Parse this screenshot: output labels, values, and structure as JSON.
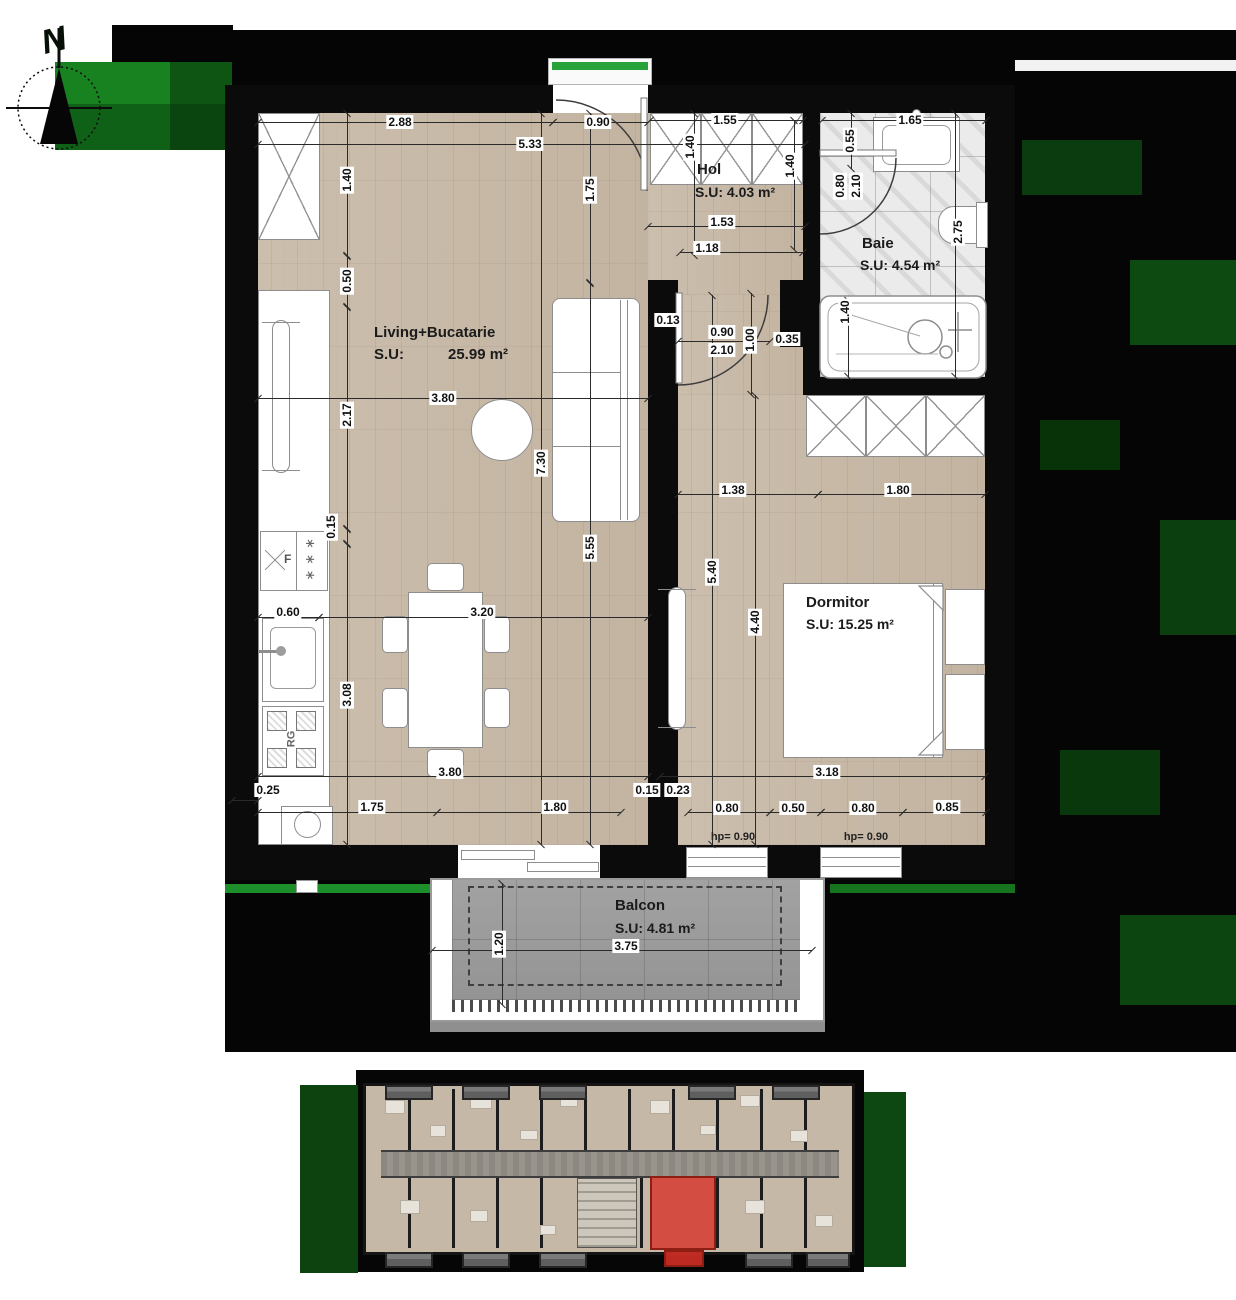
{
  "compass": {
    "north_label": "N"
  },
  "rooms": {
    "living": {
      "name": "Living+Bucatarie",
      "su_label": "S.U:",
      "area": "25.99 m²"
    },
    "hol": {
      "name": "Hol",
      "area": "S.U: 4.03 m²"
    },
    "baie": {
      "name": "Baie",
      "area": "S.U: 4.54 m²"
    },
    "dormitor": {
      "name": "Dormitor",
      "area": "S.U: 15.25 m²"
    },
    "balcon": {
      "name": "Balcon",
      "area": "S.U: 4.81 m²"
    }
  },
  "annotations": {
    "stove": "RG",
    "fridge": "F",
    "freezer": "∗∗∗"
  },
  "colors": {
    "wall": "#0b0b0b",
    "wood_floor": "#c9bbaa",
    "marble_floor": "#ebebeb",
    "balcony_tile": "#9d9d9d",
    "artifact_green": "#116b1c",
    "highlight_red": "#d63026"
  },
  "dimensions": [
    {
      "v": "2.88",
      "x": 400,
      "y": 122,
      "o": "h",
      "line": [
        258,
        122,
        553,
        122
      ]
    },
    {
      "v": "0.90",
      "x": 598,
      "y": 122,
      "o": "h",
      "line": [
        553,
        122,
        648,
        122
      ]
    },
    {
      "v": "5.33",
      "x": 530,
      "y": 144,
      "o": "h",
      "line": [
        258,
        144,
        805,
        144
      ]
    },
    {
      "v": "1.55",
      "x": 725,
      "y": 120,
      "o": "h",
      "line": [
        650,
        120,
        803,
        120
      ]
    },
    {
      "v": "0.55",
      "x": 850,
      "y": 141,
      "o": "v",
      "line": [
        851,
        113,
        851,
        169
      ]
    },
    {
      "v": "1.65",
      "x": 910,
      "y": 120,
      "o": "h",
      "line": [
        822,
        120,
        986,
        120
      ]
    },
    {
      "v": "1.40",
      "x": 690,
      "y": 147,
      "o": "v",
      "line": [
        694,
        113,
        694,
        256
      ]
    },
    {
      "v": "1.40",
      "x": 790,
      "y": 166,
      "o": "v",
      "line": [
        794,
        120,
        794,
        250
      ]
    },
    {
      "v": "1.75",
      "x": 590,
      "y": 190,
      "o": "v",
      "line": [
        590,
        113,
        590,
        283
      ]
    },
    {
      "v": "5.55",
      "x": 590,
      "y": 548,
      "o": "v",
      "line": [
        590,
        283,
        590,
        845
      ]
    },
    {
      "v": "7.30",
      "x": 541,
      "y": 463,
      "o": "v",
      "line": [
        541,
        113,
        541,
        845
      ]
    },
    {
      "v": "1.40",
      "x": 347,
      "y": 180,
      "o": "v",
      "line": [
        347,
        113,
        347,
        256
      ]
    },
    {
      "v": "0.50",
      "x": 347,
      "y": 281,
      "o": "v",
      "line": [
        347,
        256,
        347,
        307
      ]
    },
    {
      "v": "2.17",
      "x": 347,
      "y": 415,
      "o": "v",
      "line": [
        347,
        307,
        347,
        529
      ]
    },
    {
      "v": "0.15",
      "x": 331,
      "y": 527,
      "o": "v",
      "line": [
        347,
        529,
        347,
        544
      ]
    },
    {
      "v": "3.08",
      "x": 347,
      "y": 695,
      "o": "v",
      "line": [
        347,
        544,
        347,
        845
      ]
    },
    {
      "v": "0.60",
      "x": 288,
      "y": 612,
      "o": "h",
      "line": [
        258,
        617,
        319,
        617
      ]
    },
    {
      "v": "3.20",
      "x": 482,
      "y": 612,
      "o": "h",
      "line": [
        319,
        617,
        648,
        617
      ]
    },
    {
      "v": "3.80",
      "x": 443,
      "y": 398,
      "o": "h",
      "line": [
        258,
        398,
        648,
        398
      ]
    },
    {
      "v": "1.53",
      "x": 722,
      "y": 222,
      "o": "h",
      "line": [
        648,
        226,
        805,
        226
      ]
    },
    {
      "v": "1.18",
      "x": 707,
      "y": 248,
      "o": "h",
      "line": [
        680,
        252,
        803,
        252
      ]
    },
    {
      "v": "0.13",
      "x": 668,
      "y": 320,
      "o": "h"
    },
    {
      "v": "0.90",
      "x": 722,
      "y": 332,
      "o": "h",
      "line": [
        678,
        341,
        770,
        341
      ]
    },
    {
      "v": "2.10",
      "x": 722,
      "y": 350,
      "o": "h"
    },
    {
      "v": "1.00",
      "x": 750,
      "y": 340,
      "o": "v",
      "line": [
        751,
        293,
        751,
        395
      ]
    },
    {
      "v": "0.35",
      "x": 787,
      "y": 339,
      "o": "h"
    },
    {
      "v": "0.80",
      "x": 840,
      "y": 186,
      "o": "v"
    },
    {
      "v": "2.10",
      "x": 856,
      "y": 186,
      "o": "v"
    },
    {
      "v": "2.75",
      "x": 958,
      "y": 232,
      "o": "v",
      "line": [
        955,
        113,
        955,
        377
      ]
    },
    {
      "v": "1.40",
      "x": 845,
      "y": 312,
      "o": "v",
      "line": [
        848,
        300,
        848,
        377
      ]
    },
    {
      "v": "1.38",
      "x": 733,
      "y": 490,
      "o": "h",
      "line": [
        678,
        494,
        818,
        494
      ]
    },
    {
      "v": "1.80",
      "x": 898,
      "y": 490,
      "o": "h",
      "line": [
        818,
        494,
        985,
        494
      ]
    },
    {
      "v": "5.40",
      "x": 712,
      "y": 572,
      "o": "v",
      "line": [
        712,
        295,
        712,
        845
      ]
    },
    {
      "v": "4.40",
      "x": 755,
      "y": 622,
      "o": "v",
      "line": [
        755,
        395,
        755,
        845
      ]
    },
    {
      "v": "3.80",
      "x": 450,
      "y": 772,
      "o": "h",
      "line": [
        258,
        776,
        648,
        776
      ]
    },
    {
      "v": "3.18",
      "x": 827,
      "y": 772,
      "o": "h",
      "line": [
        660,
        776,
        985,
        776
      ]
    },
    {
      "v": "0.25",
      "x": 268,
      "y": 790,
      "o": "h",
      "line": [
        232,
        800,
        258,
        800
      ]
    },
    {
      "v": "1.75",
      "x": 372,
      "y": 807,
      "o": "h",
      "line": [
        258,
        812,
        437,
        812
      ]
    },
    {
      "v": "1.80",
      "x": 555,
      "y": 807,
      "o": "h",
      "line": [
        437,
        812,
        621,
        812
      ]
    },
    {
      "v": "0.15",
      "x": 647,
      "y": 790,
      "o": "h"
    },
    {
      "v": "0.23",
      "x": 678,
      "y": 790,
      "o": "h"
    },
    {
      "v": "0.80",
      "x": 727,
      "y": 808,
      "o": "h",
      "line": [
        688,
        812,
        770,
        812
      ]
    },
    {
      "v": "0.50",
      "x": 793,
      "y": 808,
      "o": "h",
      "line": [
        770,
        812,
        821,
        812
      ]
    },
    {
      "v": "0.80",
      "x": 863,
      "y": 808,
      "o": "h",
      "line": [
        821,
        812,
        903,
        812
      ]
    },
    {
      "v": "0.85",
      "x": 947,
      "y": 807,
      "o": "h",
      "line": [
        903,
        812,
        986,
        812
      ]
    },
    {
      "v": "hp= 0.90",
      "x": 733,
      "y": 837,
      "o": "h",
      "plain": true
    },
    {
      "v": "hp= 0.90",
      "x": 866,
      "y": 837,
      "o": "h",
      "plain": true
    },
    {
      "v": "1.20",
      "x": 499,
      "y": 944,
      "o": "v",
      "line": [
        502,
        883,
        502,
        1005
      ]
    },
    {
      "v": "3.75",
      "x": 626,
      "y": 946,
      "o": "h",
      "line": [
        432,
        950,
        812,
        950
      ]
    }
  ]
}
